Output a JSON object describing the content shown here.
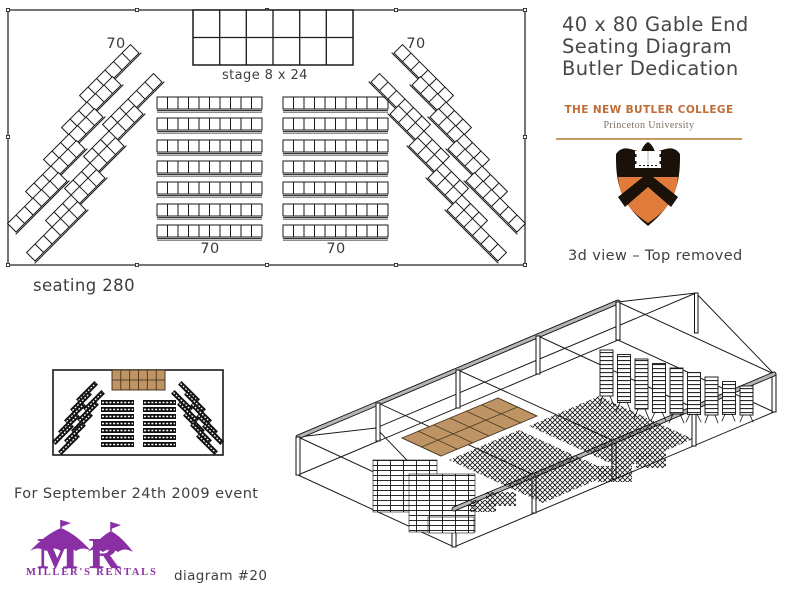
{
  "header": {
    "title_lines": [
      "40 x 80 Gable End",
      "Seating Diagram",
      "Butler Dedication"
    ]
  },
  "college": {
    "name": "THE NEW BUTLER COLLEGE",
    "university": "Princeton University"
  },
  "plan": {
    "tent_size": "40 x 80",
    "stage_label": "stage 8 x 24",
    "seating_total_label": "seating 280",
    "total_seats": 280,
    "sections": [
      {
        "name": "left-angled",
        "count": "70"
      },
      {
        "name": "center-left",
        "count": "70"
      },
      {
        "name": "center-right",
        "count": "70"
      },
      {
        "name": "right-angled",
        "count": "70"
      }
    ]
  },
  "view3d": {
    "caption": "3d view – Top removed"
  },
  "footer": {
    "event_note": "For September 24th 2009 event",
    "diagram_number": "diagram #20"
  },
  "logo": {
    "monogram": "MR",
    "company": "MILLER'S RENTALS"
  },
  "colors": {
    "college_text": "#bf6d38",
    "princeton_orange": "#e07b3c",
    "logo_purple": "#8b2fa5",
    "stage_tan": "#bf9464"
  }
}
